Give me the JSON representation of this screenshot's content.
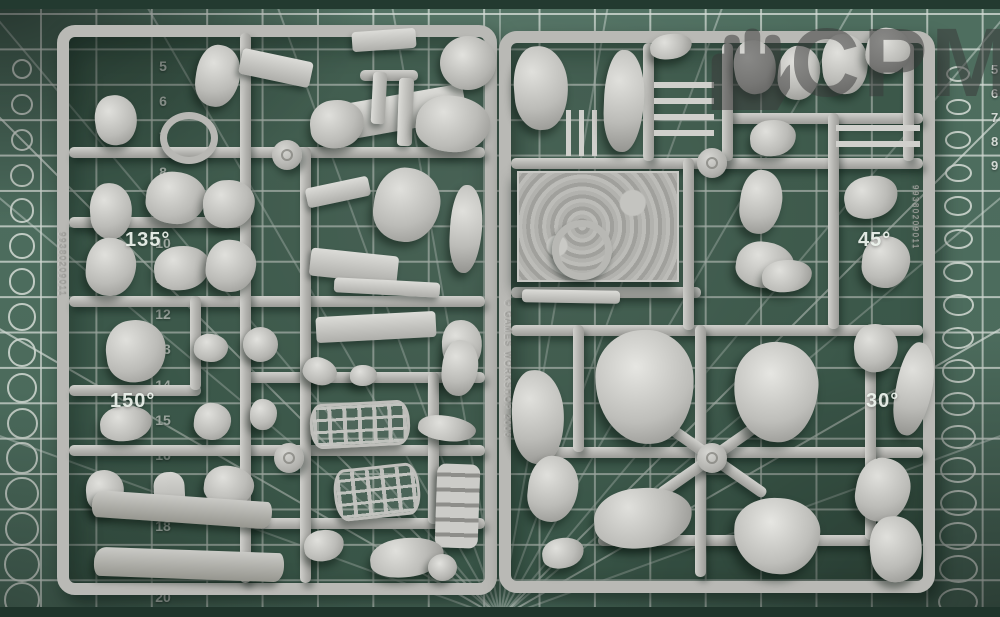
{
  "watermark": {
    "text": "CPM",
    "icon": "fist-icon"
  },
  "mat": {
    "left_scale_numbers": [
      "5",
      "6",
      "7",
      "8",
      "9",
      "10",
      "11",
      "12",
      "13",
      "14",
      "15",
      "16",
      "17",
      "18",
      "19",
      "20"
    ],
    "right_scale_numbers": [
      "5",
      "6",
      "7",
      "8",
      "9"
    ],
    "angle_labels": [
      {
        "text": "135°"
      },
      {
        "text": "45°"
      },
      {
        "text": "150°"
      },
      {
        "text": "30°"
      }
    ],
    "colors": {
      "mat_green": "#567868",
      "grid_line": "#e9f0ea",
      "sprue_gray": "#b9b9b5",
      "watermark_gray": "#3a3a3a"
    }
  },
  "sprues": {
    "left": {
      "molded_code": "99380209011"
    },
    "right": {
      "molded_copyright": "© GAMES WORKSHOP 2006",
      "molded_code": "99380209011"
    }
  }
}
